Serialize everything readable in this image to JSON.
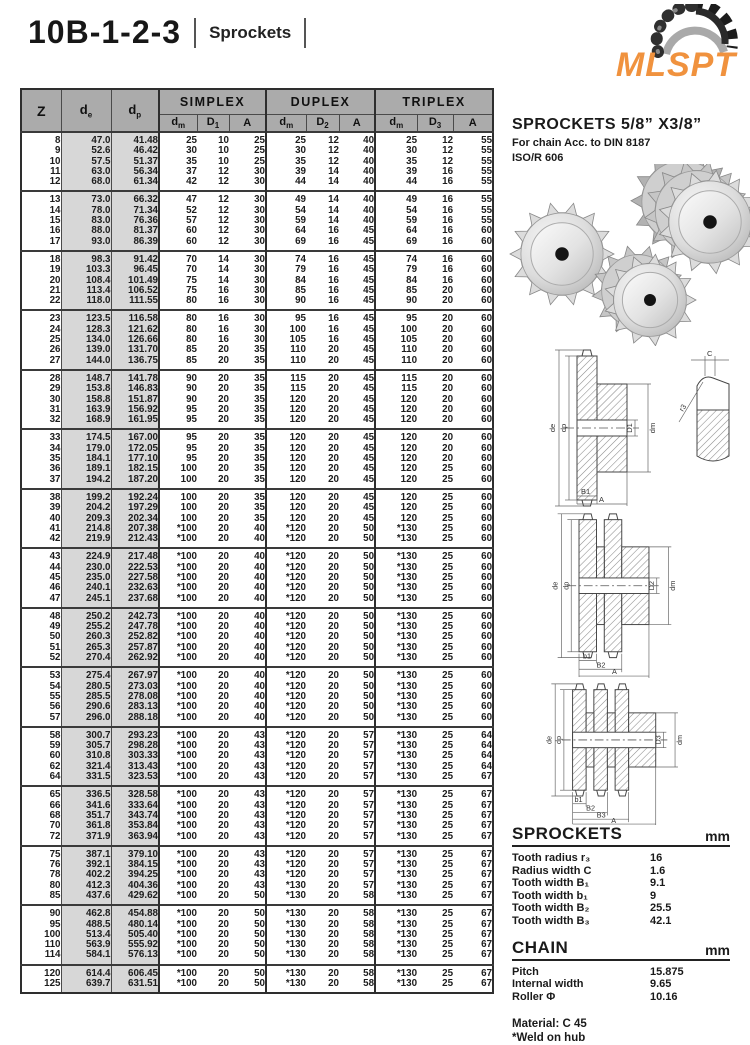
{
  "header": {
    "title": "10B-1-2-3",
    "subtitle": "Sprockets"
  },
  "logo": {
    "text": "MLSPT",
    "color": "#F0923E"
  },
  "info": {
    "heading": "SPROCKETS  5/8” X3/8”",
    "line1": "For chain Acc. to DIN 8187",
    "line2": "ISO/R 606"
  },
  "table": {
    "headers": {
      "z": "Z",
      "de": {
        "base": "d",
        "sub": "e"
      },
      "dp": {
        "base": "d",
        "sub": "p"
      },
      "simplex": "SIMPLEX",
      "duplex": "DUPLEX",
      "triplex": "TRIPLEX",
      "sub": [
        {
          "base": "d",
          "sub": "m"
        },
        {
          "base": "D",
          "sub": "1"
        },
        {
          "base": "A",
          "sub": ""
        },
        {
          "base": "d",
          "sub": "m"
        },
        {
          "base": "D",
          "sub": "2"
        },
        {
          "base": "A",
          "sub": ""
        },
        {
          "base": "d",
          "sub": "m"
        },
        {
          "base": "D",
          "sub": "3"
        },
        {
          "base": "A",
          "sub": ""
        }
      ]
    },
    "groups": [
      [
        [
          "8",
          "47.0",
          "41.48",
          "25",
          "10",
          "25",
          "25",
          "12",
          "40",
          "25",
          "12",
          "55"
        ],
        [
          "9",
          "52.6",
          "46.42",
          "30",
          "10",
          "25",
          "30",
          "12",
          "40",
          "30",
          "12",
          "55"
        ],
        [
          "10",
          "57.5",
          "51.37",
          "35",
          "10",
          "25",
          "35",
          "12",
          "40",
          "35",
          "12",
          "55"
        ],
        [
          "11",
          "63.0",
          "56.34",
          "37",
          "12",
          "30",
          "39",
          "14",
          "40",
          "39",
          "16",
          "55"
        ],
        [
          "12",
          "68.0",
          "61.34",
          "42",
          "12",
          "30",
          "44",
          "14",
          "40",
          "44",
          "16",
          "55"
        ]
      ],
      [
        [
          "13",
          "73.0",
          "66.32",
          "47",
          "12",
          "30",
          "49",
          "14",
          "40",
          "49",
          "16",
          "55"
        ],
        [
          "14",
          "78.0",
          "71.34",
          "52",
          "12",
          "30",
          "54",
          "14",
          "40",
          "54",
          "16",
          "55"
        ],
        [
          "15",
          "83.0",
          "76.36",
          "57",
          "12",
          "30",
          "59",
          "14",
          "40",
          "59",
          "16",
          "55"
        ],
        [
          "16",
          "88.0",
          "81.37",
          "60",
          "12",
          "30",
          "64",
          "16",
          "45",
          "64",
          "16",
          "60"
        ],
        [
          "17",
          "93.0",
          "86.39",
          "60",
          "12",
          "30",
          "69",
          "16",
          "45",
          "69",
          "16",
          "60"
        ]
      ],
      [
        [
          "18",
          "98.3",
          "91.42",
          "70",
          "14",
          "30",
          "74",
          "16",
          "45",
          "74",
          "16",
          "60"
        ],
        [
          "19",
          "103.3",
          "96.45",
          "70",
          "14",
          "30",
          "79",
          "16",
          "45",
          "79",
          "16",
          "60"
        ],
        [
          "20",
          "108.4",
          "101.49",
          "75",
          "14",
          "30",
          "84",
          "16",
          "45",
          "84",
          "16",
          "60"
        ],
        [
          "21",
          "113.4",
          "106.52",
          "75",
          "16",
          "30",
          "85",
          "16",
          "45",
          "85",
          "20",
          "60"
        ],
        [
          "22",
          "118.0",
          "111.55",
          "80",
          "16",
          "30",
          "90",
          "16",
          "45",
          "90",
          "20",
          "60"
        ]
      ],
      [
        [
          "23",
          "123.5",
          "116.58",
          "80",
          "16",
          "30",
          "95",
          "16",
          "45",
          "95",
          "20",
          "60"
        ],
        [
          "24",
          "128.3",
          "121.62",
          "80",
          "16",
          "30",
          "100",
          "16",
          "45",
          "100",
          "20",
          "60"
        ],
        [
          "25",
          "134.0",
          "126.66",
          "80",
          "16",
          "30",
          "105",
          "16",
          "45",
          "105",
          "20",
          "60"
        ],
        [
          "26",
          "139.0",
          "131.70",
          "85",
          "20",
          "35",
          "110",
          "20",
          "45",
          "110",
          "20",
          "60"
        ],
        [
          "27",
          "144.0",
          "136.75",
          "85",
          "20",
          "35",
          "110",
          "20",
          "45",
          "110",
          "20",
          "60"
        ]
      ],
      [
        [
          "28",
          "148.7",
          "141.78",
          "90",
          "20",
          "35",
          "115",
          "20",
          "45",
          "115",
          "20",
          "60"
        ],
        [
          "29",
          "153.8",
          "146.83",
          "90",
          "20",
          "35",
          "115",
          "20",
          "45",
          "115",
          "20",
          "60"
        ],
        [
          "30",
          "158.8",
          "151.87",
          "90",
          "20",
          "35",
          "120",
          "20",
          "45",
          "120",
          "20",
          "60"
        ],
        [
          "31",
          "163.9",
          "156.92",
          "95",
          "20",
          "35",
          "120",
          "20",
          "45",
          "120",
          "20",
          "60"
        ],
        [
          "32",
          "168.9",
          "161.95",
          "95",
          "20",
          "35",
          "120",
          "20",
          "45",
          "120",
          "20",
          "60"
        ]
      ],
      [
        [
          "33",
          "174.5",
          "167.00",
          "95",
          "20",
          "35",
          "120",
          "20",
          "45",
          "120",
          "20",
          "60"
        ],
        [
          "34",
          "179.0",
          "172.05",
          "95",
          "20",
          "35",
          "120",
          "20",
          "45",
          "120",
          "20",
          "60"
        ],
        [
          "35",
          "184.1",
          "177.10",
          "95",
          "20",
          "35",
          "120",
          "20",
          "45",
          "120",
          "20",
          "60"
        ],
        [
          "36",
          "189.1",
          "182.15",
          "100",
          "20",
          "35",
          "120",
          "20",
          "45",
          "120",
          "25",
          "60"
        ],
        [
          "37",
          "194.2",
          "187.20",
          "100",
          "20",
          "35",
          "120",
          "20",
          "45",
          "120",
          "25",
          "60"
        ]
      ],
      [
        [
          "38",
          "199.2",
          "192.24",
          "100",
          "20",
          "35",
          "120",
          "20",
          "45",
          "120",
          "25",
          "60"
        ],
        [
          "39",
          "204.2",
          "197.29",
          "100",
          "20",
          "35",
          "120",
          "20",
          "45",
          "120",
          "25",
          "60"
        ],
        [
          "40",
          "209.3",
          "202.34",
          "100",
          "20",
          "35",
          "120",
          "20",
          "45",
          "120",
          "25",
          "60"
        ],
        [
          "41",
          "214.8",
          "207.38",
          "*100",
          "20",
          "40",
          "*120",
          "20",
          "50",
          "*130",
          "25",
          "60"
        ],
        [
          "42",
          "219.9",
          "212.43",
          "*100",
          "20",
          "40",
          "*120",
          "20",
          "50",
          "*130",
          "25",
          "60"
        ]
      ],
      [
        [
          "43",
          "224.9",
          "217.48",
          "*100",
          "20",
          "40",
          "*120",
          "20",
          "50",
          "*130",
          "25",
          "60"
        ],
        [
          "44",
          "230.0",
          "222.53",
          "*100",
          "20",
          "40",
          "*120",
          "20",
          "50",
          "*130",
          "25",
          "60"
        ],
        [
          "45",
          "235.0",
          "227.58",
          "*100",
          "20",
          "40",
          "*120",
          "20",
          "50",
          "*130",
          "25",
          "60"
        ],
        [
          "46",
          "240.1",
          "232.63",
          "*100",
          "20",
          "40",
          "*120",
          "20",
          "50",
          "*130",
          "25",
          "60"
        ],
        [
          "47",
          "245.1",
          "237.68",
          "*100",
          "20",
          "40",
          "*120",
          "20",
          "50",
          "*130",
          "25",
          "60"
        ]
      ],
      [
        [
          "48",
          "250.2",
          "242.73",
          "*100",
          "20",
          "40",
          "*120",
          "20",
          "50",
          "*130",
          "25",
          "60"
        ],
        [
          "49",
          "255.2",
          "247.78",
          "*100",
          "20",
          "40",
          "*120",
          "20",
          "50",
          "*130",
          "25",
          "60"
        ],
        [
          "50",
          "260.3",
          "252.82",
          "*100",
          "20",
          "40",
          "*120",
          "20",
          "50",
          "*130",
          "25",
          "60"
        ],
        [
          "51",
          "265.3",
          "257.87",
          "*100",
          "20",
          "40",
          "*120",
          "20",
          "50",
          "*130",
          "25",
          "60"
        ],
        [
          "52",
          "270.4",
          "262.92",
          "*100",
          "20",
          "40",
          "*120",
          "20",
          "50",
          "*130",
          "25",
          "60"
        ]
      ],
      [
        [
          "53",
          "275.4",
          "267.97",
          "*100",
          "20",
          "40",
          "*120",
          "20",
          "50",
          "*130",
          "25",
          "60"
        ],
        [
          "54",
          "280.5",
          "273.03",
          "*100",
          "20",
          "40",
          "*120",
          "20",
          "50",
          "*130",
          "25",
          "60"
        ],
        [
          "55",
          "285.5",
          "278.08",
          "*100",
          "20",
          "40",
          "*120",
          "20",
          "50",
          "*130",
          "25",
          "60"
        ],
        [
          "56",
          "290.6",
          "283.13",
          "*100",
          "20",
          "40",
          "*120",
          "20",
          "50",
          "*130",
          "25",
          "60"
        ],
        [
          "57",
          "296.0",
          "288.18",
          "*100",
          "20",
          "40",
          "*120",
          "20",
          "50",
          "*130",
          "25",
          "60"
        ]
      ],
      [
        [
          "58",
          "300.7",
          "293.23",
          "*100",
          "20",
          "43",
          "*120",
          "20",
          "57",
          "*130",
          "25",
          "64"
        ],
        [
          "59",
          "305.7",
          "298.28",
          "*100",
          "20",
          "43",
          "*120",
          "20",
          "57",
          "*130",
          "25",
          "64"
        ],
        [
          "60",
          "310.8",
          "303.33",
          "*100",
          "20",
          "43",
          "*120",
          "20",
          "57",
          "*130",
          "25",
          "64"
        ],
        [
          "62",
          "321.4",
          "313.43",
          "*100",
          "20",
          "43",
          "*120",
          "20",
          "57",
          "*130",
          "25",
          "64"
        ],
        [
          "64",
          "331.5",
          "323.53",
          "*100",
          "20",
          "43",
          "*120",
          "20",
          "57",
          "*130",
          "25",
          "67"
        ]
      ],
      [
        [
          "65",
          "336.5",
          "328.58",
          "*100",
          "20",
          "43",
          "*120",
          "20",
          "57",
          "*130",
          "25",
          "67"
        ],
        [
          "66",
          "341.6",
          "333.64",
          "*100",
          "20",
          "43",
          "*120",
          "20",
          "57",
          "*130",
          "25",
          "67"
        ],
        [
          "68",
          "351.7",
          "343.74",
          "*100",
          "20",
          "43",
          "*120",
          "20",
          "57",
          "*130",
          "25",
          "67"
        ],
        [
          "70",
          "361.8",
          "353.84",
          "*100",
          "20",
          "43",
          "*120",
          "20",
          "57",
          "*130",
          "25",
          "67"
        ],
        [
          "72",
          "371.9",
          "363.94",
          "*100",
          "20",
          "43",
          "*120",
          "20",
          "57",
          "*130",
          "25",
          "67"
        ]
      ],
      [
        [
          "75",
          "387.1",
          "379.10",
          "*100",
          "20",
          "43",
          "*120",
          "20",
          "57",
          "*130",
          "25",
          "67"
        ],
        [
          "76",
          "392.1",
          "384.15",
          "*100",
          "20",
          "43",
          "*120",
          "20",
          "57",
          "*130",
          "25",
          "67"
        ],
        [
          "78",
          "402.2",
          "394.25",
          "*100",
          "20",
          "43",
          "*120",
          "20",
          "57",
          "*130",
          "25",
          "67"
        ],
        [
          "80",
          "412.3",
          "404.36",
          "*100",
          "20",
          "43",
          "*130",
          "20",
          "57",
          "*130",
          "25",
          "67"
        ],
        [
          "85",
          "437.6",
          "429.62",
          "*100",
          "20",
          "50",
          "*130",
          "20",
          "58",
          "*130",
          "25",
          "67"
        ]
      ],
      [
        [
          "90",
          "462.8",
          "454.88",
          "*100",
          "20",
          "50",
          "*130",
          "20",
          "58",
          "*130",
          "25",
          "67"
        ],
        [
          "95",
          "488.5",
          "480.14",
          "*100",
          "20",
          "50",
          "*130",
          "20",
          "58",
          "*130",
          "25",
          "67"
        ],
        [
          "100",
          "513.4",
          "505.40",
          "*100",
          "20",
          "50",
          "*130",
          "20",
          "58",
          "*130",
          "25",
          "67"
        ],
        [
          "110",
          "563.9",
          "555.92",
          "*100",
          "20",
          "50",
          "*130",
          "20",
          "58",
          "*130",
          "25",
          "67"
        ],
        [
          "114",
          "584.1",
          "576.13",
          "*100",
          "20",
          "50",
          "*130",
          "20",
          "58",
          "*130",
          "25",
          "67"
        ]
      ],
      [
        [
          "120",
          "614.4",
          "606.45",
          "*100",
          "20",
          "50",
          "*130",
          "20",
          "58",
          "*130",
          "25",
          "67"
        ],
        [
          "125",
          "639.7",
          "631.51",
          "*100",
          "20",
          "50",
          "*130",
          "20",
          "58",
          "*130",
          "25",
          "67"
        ]
      ]
    ]
  },
  "diagrams": {
    "simplex": {
      "side": [
        "de",
        "dp"
      ],
      "right": [
        "D1",
        "dm"
      ],
      "bottom": [
        "B1",
        "A"
      ]
    },
    "tooth": {
      "top": "C",
      "radius": "r3"
    },
    "duplex": {
      "side": [
        "de",
        "dp"
      ],
      "right": [
        "D2",
        "dm"
      ],
      "bottom": [
        "b1",
        "B2",
        "A"
      ]
    },
    "triplex": {
      "side": [
        "de",
        "dp"
      ],
      "right": [
        "D3",
        "dm"
      ],
      "bottom": [
        "b1",
        "B2",
        "B3",
        "A"
      ]
    }
  },
  "specs": {
    "title": "SPROCKETS",
    "unit": "mm",
    "rows": [
      [
        "Tooth radius r₃",
        "16"
      ],
      [
        "Radius width C",
        "1.6"
      ],
      [
        "Tooth width B₁",
        "9.1"
      ],
      [
        "Tooth width b₁",
        "9"
      ],
      [
        "Tooth width B₂",
        "25.5"
      ],
      [
        "Tooth width B₃",
        "42.1"
      ]
    ]
  },
  "chain": {
    "title": "CHAIN",
    "unit": "mm",
    "rows": [
      [
        "Pitch",
        "15.875"
      ],
      [
        "Internal width",
        "9.65"
      ],
      [
        "Roller Φ",
        "10.16"
      ]
    ]
  },
  "notes": {
    "material": "Material: C 45",
    "weld": "*Weld on hub"
  }
}
